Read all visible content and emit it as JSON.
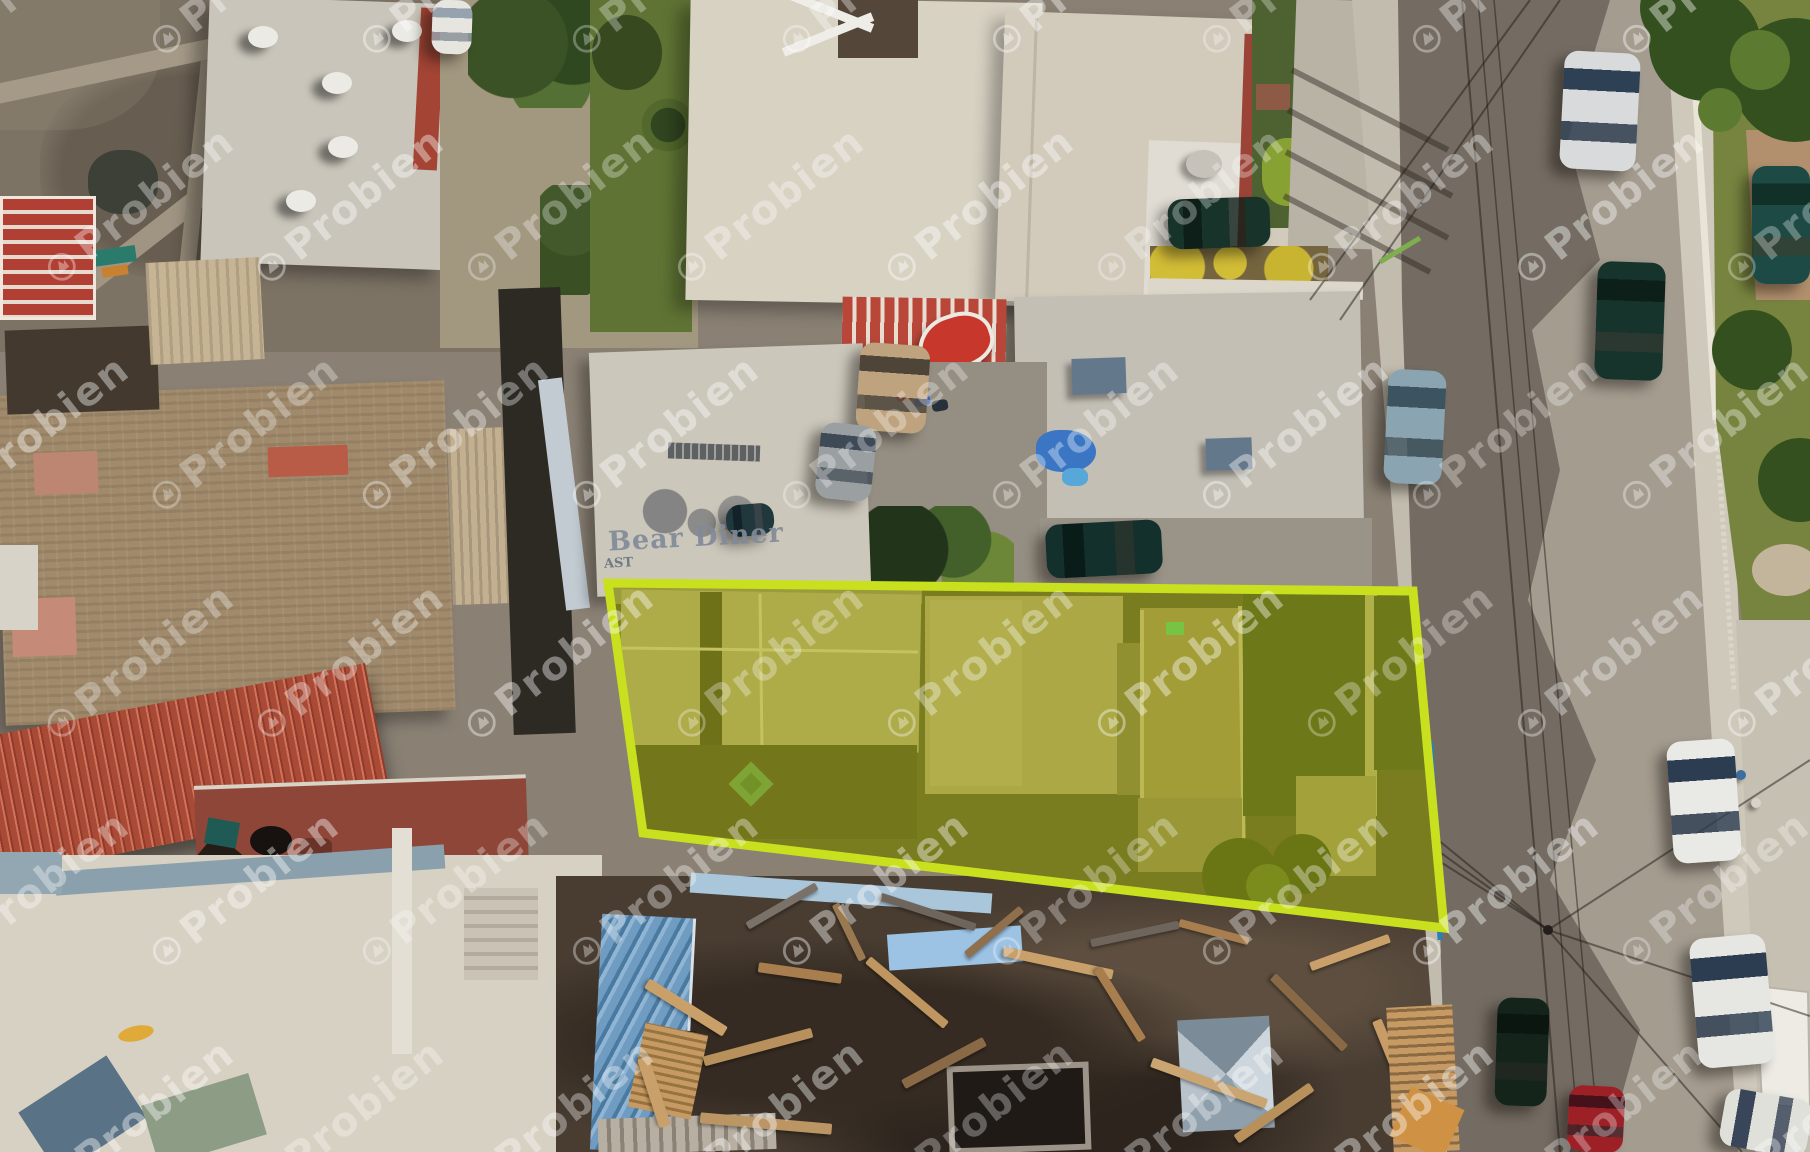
{
  "watermark": {
    "text": "Probien",
    "color": "#ffffff",
    "opacity": 0.3,
    "rotation_deg": -38,
    "grid": {
      "cols": 10,
      "rows": 6,
      "dx": 210,
      "dy": 228,
      "stagger": 105,
      "x0": -55,
      "y0": 25
    }
  },
  "signs": {
    "roof_sign": "Bear Diner",
    "roof_sign_partial": "AST"
  },
  "highlight": {
    "polygon": [
      [
        608,
        583
      ],
      [
        1413,
        591
      ],
      [
        1444,
        928
      ],
      [
        643,
        833
      ]
    ],
    "stroke": "#c8e01e",
    "stroke_width": 9,
    "fill": "rgba(219,228,16,0.40)",
    "ground": "#3a372c"
  },
  "vents": [
    [
      248,
      26
    ],
    [
      392,
      20
    ],
    [
      322,
      72
    ],
    [
      328,
      136
    ],
    [
      286,
      190
    ]
  ],
  "bikes": [
    [
      896,
      390,
      "#c43a2e"
    ],
    [
      914,
      395,
      "#2e5fc4"
    ],
    [
      932,
      400,
      "#28303a"
    ]
  ],
  "people": [
    [
      1736,
      770,
      "#3a6fa0"
    ],
    [
      1751,
      798,
      "#d8d3c8"
    ]
  ],
  "planks": [
    [
      640,
      1002,
      92,
      11,
      32,
      "#c9a06a"
    ],
    [
      702,
      1042,
      112,
      10,
      -15,
      "#b8905c"
    ],
    [
      758,
      968,
      84,
      10,
      8,
      "#a87e4e"
    ],
    [
      618,
      1086,
      72,
      12,
      72,
      "#c9a06a"
    ],
    [
      856,
      988,
      102,
      9,
      40,
      "#bf9560"
    ],
    [
      898,
      1058,
      92,
      10,
      -28,
      "#8a6a46"
    ],
    [
      1002,
      958,
      112,
      10,
      12,
      "#c9a06a"
    ],
    [
      1078,
      1000,
      84,
      9,
      58,
      "#a87e4e"
    ],
    [
      1148,
      1078,
      122,
      10,
      20,
      "#caa571"
    ],
    [
      1228,
      1108,
      92,
      10,
      -35,
      "#b8905c"
    ],
    [
      1258,
      1008,
      102,
      9,
      45,
      "#8a6a46"
    ],
    [
      1308,
      948,
      84,
      9,
      -20,
      "#c9a06a"
    ],
    [
      1178,
      928,
      72,
      8,
      15,
      "#a87e4e"
    ],
    [
      700,
      1118,
      132,
      11,
      5,
      "#bb9564"
    ],
    [
      958,
      928,
      72,
      8,
      -40,
      "#90704c"
    ],
    [
      1348,
      1058,
      92,
      10,
      68,
      "#c79c66"
    ],
    [
      818,
      928,
      62,
      8,
      64,
      "#9a7850"
    ],
    [
      878,
      908,
      100,
      8,
      18,
      "#6e665c"
    ],
    [
      1090,
      930,
      90,
      8,
      -12,
      "#6e665c"
    ],
    [
      742,
      902,
      80,
      8,
      -30,
      "#7a7268"
    ]
  ],
  "cars": [
    {
      "name": "silver-sedan-road",
      "x": 1562,
      "y": 52,
      "w": 76,
      "h": 118,
      "rot": 3,
      "o": "v",
      "body": "#d8dadb",
      "glass": "#2e4054"
    },
    {
      "name": "dark-suv-road",
      "x": 1596,
      "y": 262,
      "w": 68,
      "h": 118,
      "rot": 2,
      "o": "v",
      "body": "#16342b",
      "glass": "#0d1f19"
    },
    {
      "name": "teal-suv-edge",
      "x": 1752,
      "y": 166,
      "w": 58,
      "h": 118,
      "rot": 0,
      "o": "v",
      "body": "#1d4a44",
      "glass": "#113028"
    },
    {
      "name": "flatbed-truck",
      "x": 1386,
      "y": 370,
      "w": 58,
      "h": 114,
      "rot": 3,
      "o": "v",
      "body": "#8ba4b2",
      "glass": "#3c545f"
    },
    {
      "name": "green-suv-driveway",
      "x": 1168,
      "y": 198,
      "w": 102,
      "h": 50,
      "rot": -2,
      "o": "h",
      "body": "#17332a",
      "glass": "#0d1f18"
    },
    {
      "name": "teal-suv-lot",
      "x": 1046,
      "y": 522,
      "w": 116,
      "h": 54,
      "rot": -3,
      "o": "h",
      "body": "#14302d",
      "glass": "#0a1c18"
    },
    {
      "name": "tan-car",
      "x": 858,
      "y": 344,
      "w": 70,
      "h": 88,
      "rot": 4,
      "o": "v",
      "body": "#bfa37e",
      "glass": "#4e4538"
    },
    {
      "name": "gray-car-driveway",
      "x": 818,
      "y": 424,
      "w": 56,
      "h": 76,
      "rot": 6,
      "o": "v",
      "body": "#9aa0a2",
      "glass": "#3e4a56"
    },
    {
      "name": "small-dark-car",
      "x": 726,
      "y": 504,
      "w": 48,
      "h": 32,
      "rot": -5,
      "o": "h",
      "body": "#20383c",
      "glass": "#122228"
    },
    {
      "name": "white-car-1",
      "x": 1670,
      "y": 740,
      "w": 68,
      "h": 122,
      "rot": -4,
      "o": "v",
      "body": "#e9e9e6",
      "glass": "#2c3d52"
    },
    {
      "name": "white-car-2",
      "x": 1694,
      "y": 936,
      "w": 76,
      "h": 130,
      "rot": -5,
      "o": "v",
      "body": "#e6e6e2",
      "glass": "#2c3d52"
    },
    {
      "name": "white-pickup-corner",
      "x": 1722,
      "y": 1094,
      "w": 88,
      "h": 58,
      "rot": 10,
      "o": "h",
      "body": "#e0e0db",
      "glass": "#39465a"
    },
    {
      "name": "dark-suv-bottom",
      "x": 1496,
      "y": 998,
      "w": 52,
      "h": 108,
      "rot": 2,
      "o": "v",
      "body": "#15241b",
      "glass": "#0b1611"
    },
    {
      "name": "red-car-bottom",
      "x": 1568,
      "y": 1086,
      "w": 56,
      "h": 66,
      "rot": 3,
      "o": "v",
      "body": "#9c2026",
      "glass": "#45121a"
    },
    {
      "name": "white-van-top",
      "x": 432,
      "y": 0,
      "w": 40,
      "h": 54,
      "rot": 2,
      "o": "v",
      "body": "#e7e5df",
      "glass": "#96a2ae"
    }
  ]
}
